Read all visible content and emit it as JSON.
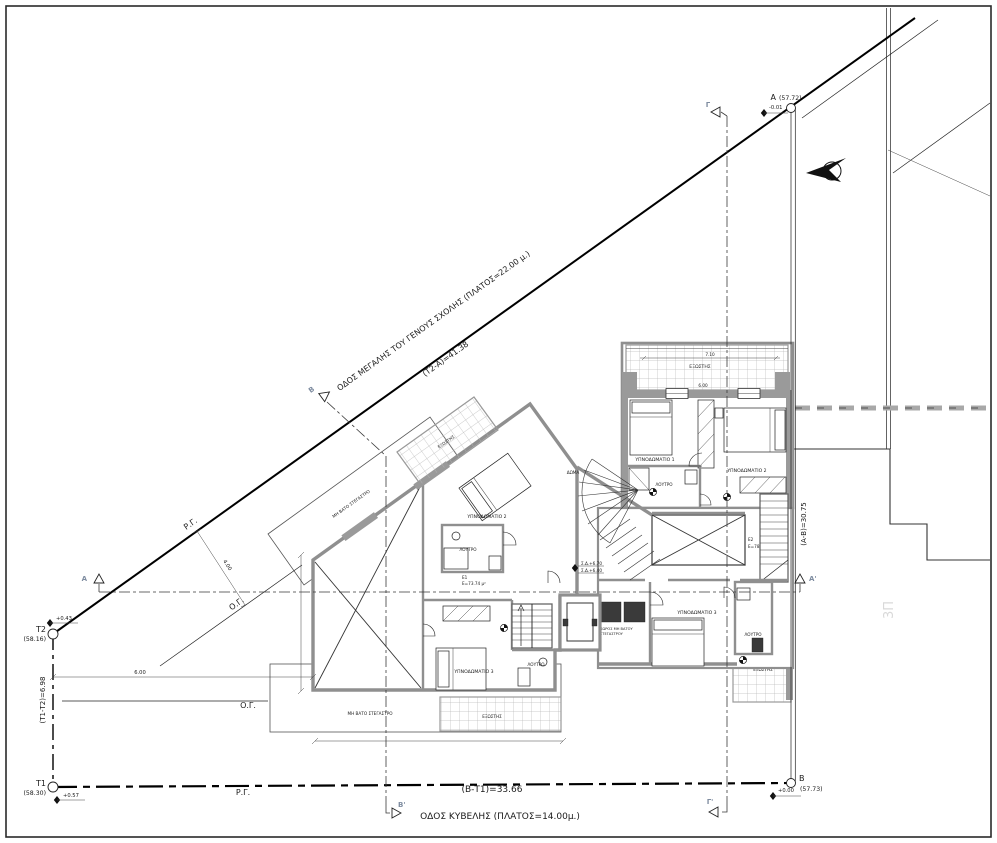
{
  "drawing": {
    "type": "architectural site / floor plan"
  },
  "streets": {
    "megalis": {
      "name": "ΟΔΟΣ ΜΕΓΑΛΗΣ ΤΟΥ ΓΕΝΟΥΣ ΣΧΟΛΗΣ (ΠΛΑΤΟΣ=22.00 μ.)",
      "dim": "(Τ2-Α)=41.38"
    },
    "kyvelis": {
      "name": "ΟΔΟΣ ΚΥΒΕΛΗΣ (ΠΛΑΤΟΣ=14.00μ.)",
      "dim": "(Β-Τ1)=33.66"
    }
  },
  "points": {
    "t1": {
      "label": "Τ1",
      "elevation": "(58.30)",
      "spot": "+0.57"
    },
    "t2": {
      "label": "Τ2",
      "elevation": "(58.16)",
      "spot": "+0.43"
    },
    "a": {
      "label": "Α",
      "elevation": "(57.72)",
      "spot": "-0.01"
    },
    "b": {
      "label": "Β",
      "elevation": "(57.73)",
      "spot": "+0.00"
    }
  },
  "boundary_dims": {
    "left": "(Τ1-Τ2)=6.98",
    "right": "(Α-Β)=30.75",
    "front_offset": "6.00",
    "setback": "4.00"
  },
  "lines": {
    "rg": "Ρ.Γ.",
    "og": "Ο.Γ."
  },
  "sections": {
    "a": "Α",
    "a_prime": "Α'",
    "b": "Β",
    "b_prime": "Β'",
    "g": "Γ",
    "g_prime": "Γ'"
  },
  "rooms": {
    "bedroom1": "ΥΠΝΟΔΩΜΑΤΙΟ 1",
    "bedroom2": "ΥΠΝΟΔΩΜΑΤΙΟ 2",
    "bedroom3": "ΥΠΝΟΔΩΜΑΤΙΟ 3",
    "bathroom": "ΛΟΥΤΡΟ",
    "balcony": "ΕΞΩΣΤΗΣ",
    "canopy": "ΜΗ ΒΑΤΟ ΣΤΕΓΑΣΤΡΟ",
    "roof_access": "ΔΩΜΑ"
  },
  "areas": {
    "e1_label": "Ε1",
    "e1_value": "Ε=73.74 μ²",
    "e2_label": "Ε2",
    "e2_value": "Ε=78.39 μ²"
  },
  "levels": {
    "sd_upper": "Σ.Δ.+6.70",
    "sd_lower": "Σ.Δ.+6.40"
  },
  "small_dims": {
    "balcony_width": "7.10",
    "balcony_depth": "6.00"
  },
  "annotations": {
    "canopy_small_1": "ΧΩΡΟΣ ΜΗ ΒΑΤΟΥ",
    "canopy_small_2": "ΣΤΕΓΑΣΤΡΟΥ",
    "neighbor_floors": "3Π"
  },
  "colors": {
    "wall": "#8f8f8f",
    "section_label": "#7e8ca0",
    "hatch": "#bbbbbb",
    "line": "#1a1a1a"
  }
}
